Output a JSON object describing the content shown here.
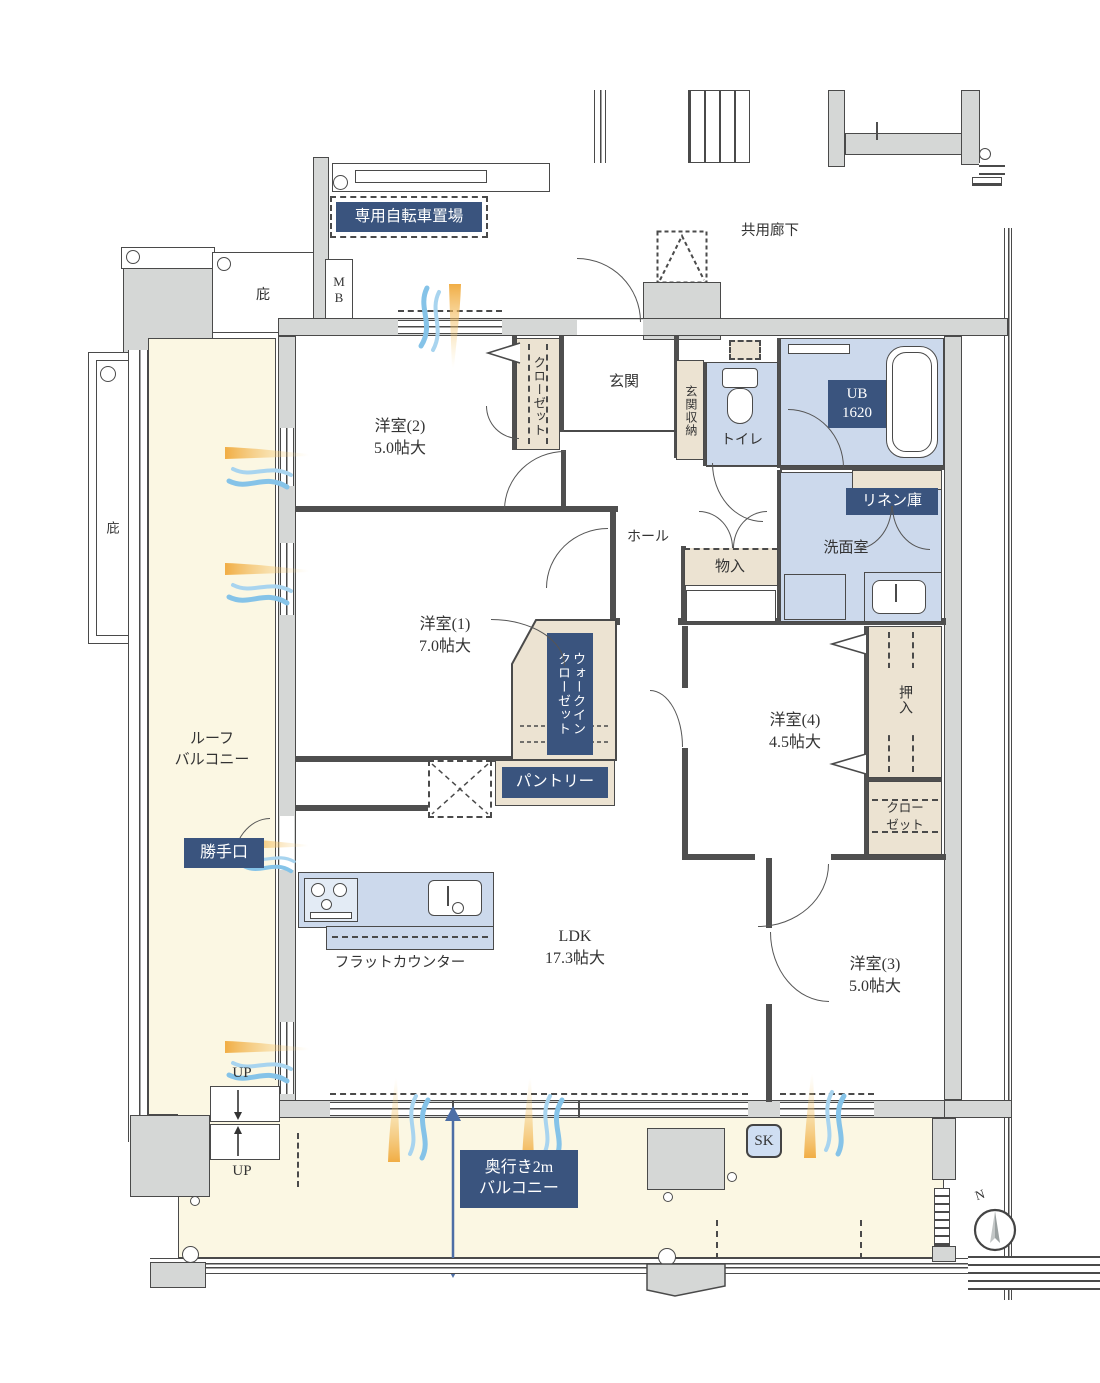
{
  "plan": {
    "outside": {
      "bicycle_parking": "専用自転車置場",
      "common_corridor": "共用廊下",
      "eaves_top": "庇",
      "eaves_left": "庇",
      "meter_box": "M\nB",
      "north": "N"
    },
    "rooms": {
      "bedroom2": {
        "name": "洋室(2)",
        "size": "5.0帖大"
      },
      "bedroom1": {
        "name": "洋室(1)",
        "size": "7.0帖大"
      },
      "bedroom4": {
        "name": "洋室(4)",
        "size": "4.5帖大"
      },
      "bedroom3": {
        "name": "洋室(3)",
        "size": "5.0帖大"
      },
      "ldk": {
        "name": "LDK",
        "size": "17.3帖大"
      },
      "entrance": "玄関",
      "hall": "ホール",
      "toilet": "トイレ",
      "washroom": "洗面室",
      "unit_bath": "UB\n1620"
    },
    "storage": {
      "closet2": "クローゼット",
      "entrance_storage": "玄関収納",
      "linen": "リネン庫",
      "monoire": "物入",
      "walk_in_closet": "ウォークイン\nクローゼット",
      "pantry": "パントリー",
      "oshiire": "押入",
      "closet4": "クロー\nゼット"
    },
    "kitchen": {
      "flat_counter": "フラットカウンター",
      "back_door": "勝手口"
    },
    "balcony": {
      "roof": "ルーフ\nバルコニー",
      "depth": "奥行き2m\nバルコニー",
      "sk": "SK",
      "up_top": "UP",
      "up_bottom": "UP"
    }
  }
}
